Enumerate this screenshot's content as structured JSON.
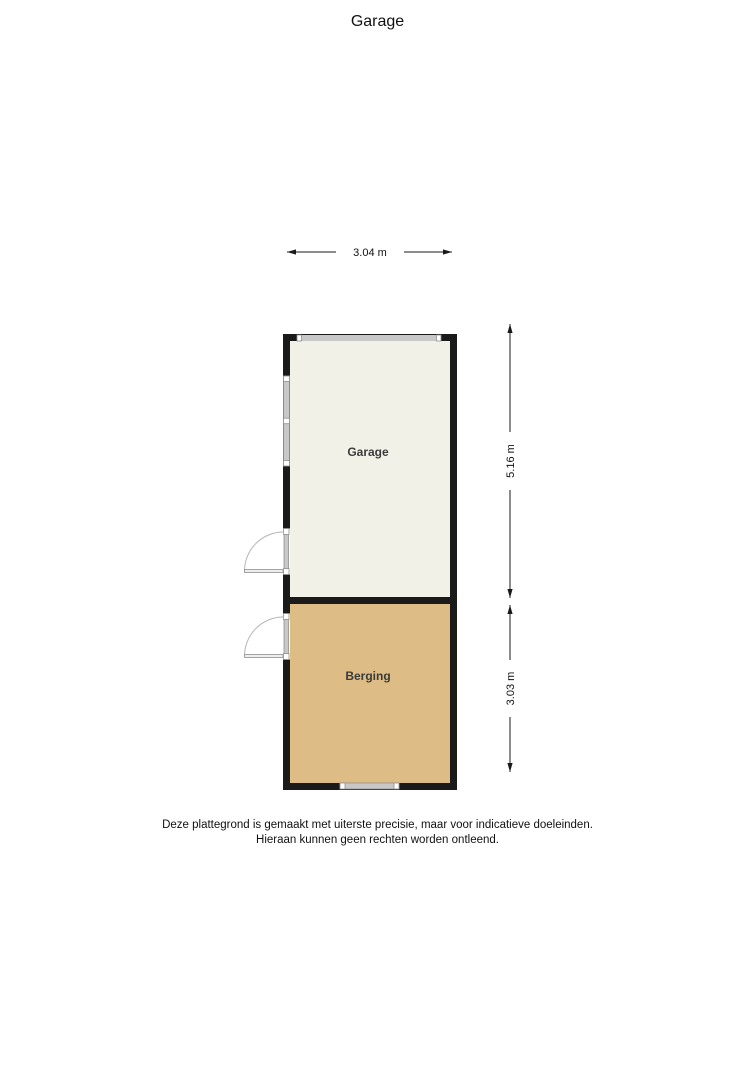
{
  "page": {
    "title": "Garage",
    "disclaimer": {
      "line1": "Deze plattegrond is gemaakt met uiterste precisie, maar voor indicatieve doeleinden.",
      "line2": "Hieraan kunnen geen rechten worden ontleend."
    }
  },
  "floorplan": {
    "rooms": [
      {
        "name": "Garage",
        "floor_color": "#f2f1e8"
      },
      {
        "name": "Berging",
        "floor_color": "#ddbd85"
      }
    ],
    "dimensions": {
      "top_width": "3.04 m",
      "garage_height": "5.16 m",
      "berging_height": "3.03 m"
    },
    "colors": {
      "wall": "#1a1a1a",
      "window_glass": "#c8c8c8",
      "window_frame": "#909090",
      "door_swing": "#b5b5b5",
      "door_leaf": "#ededed",
      "dimension_line": "#1a1a1a"
    }
  }
}
